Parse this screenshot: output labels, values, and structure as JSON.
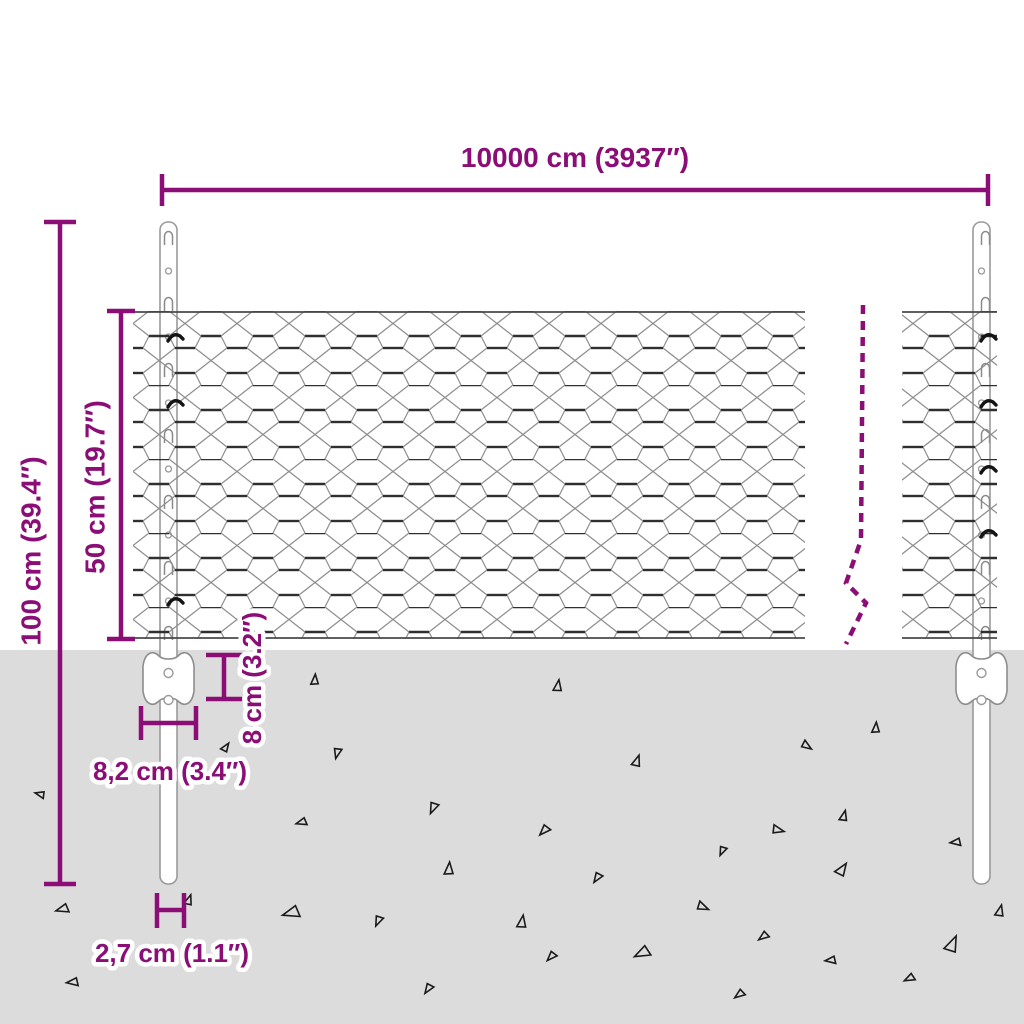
{
  "type": "product-dimension-diagram",
  "subject": "wire mesh fence with metal posts, partially buried in ground",
  "colors": {
    "accent": "#8a0e76",
    "ground": "#dcdcdc",
    "mesh_wire_thin": "#8c8c8c",
    "mesh_wire_twist": "#2f2f2f",
    "post_outline": "#9a9a9a",
    "background": "#ffffff"
  },
  "dimensions": {
    "total_width": {
      "label": "10000 cm (3937″)",
      "orientation": "horizontal"
    },
    "post_height": {
      "label": "100 cm (39.4″)",
      "orientation": "vertical"
    },
    "mesh_height": {
      "label": "50 cm (19.7″)",
      "orientation": "vertical"
    },
    "bracket_depth": {
      "label": "8 cm (3.2″)",
      "orientation": "vertical"
    },
    "bracket_width": {
      "label": "8,2 cm (3.4″)",
      "orientation": "horizontal"
    },
    "post_width": {
      "label": "2,7 cm (1.1″)",
      "orientation": "horizontal"
    }
  },
  "ground": {
    "triangles": [
      {
        "x": 314,
        "y": 680,
        "s": 10,
        "r": 0
      },
      {
        "x": 557,
        "y": 686,
        "s": 11,
        "r": 5
      },
      {
        "x": 338,
        "y": 753,
        "s": 10,
        "r": 190
      },
      {
        "x": 636,
        "y": 761,
        "s": 11,
        "r": 15
      },
      {
        "x": 807,
        "y": 745,
        "s": 10,
        "r": 120
      },
      {
        "x": 875,
        "y": 728,
        "s": 10,
        "r": 0
      },
      {
        "x": 434,
        "y": 808,
        "s": 11,
        "r": 200
      },
      {
        "x": 302,
        "y": 823,
        "s": 10,
        "r": 250
      },
      {
        "x": 545,
        "y": 831,
        "s": 11,
        "r": 220
      },
      {
        "x": 778,
        "y": 829,
        "s": 11,
        "r": 100
      },
      {
        "x": 843,
        "y": 816,
        "s": 10,
        "r": 10
      },
      {
        "x": 723,
        "y": 851,
        "s": 9,
        "r": 200
      },
      {
        "x": 956,
        "y": 843,
        "s": 10,
        "r": 260
      },
      {
        "x": 448,
        "y": 869,
        "s": 12,
        "r": 0
      },
      {
        "x": 598,
        "y": 878,
        "s": 10,
        "r": 210
      },
      {
        "x": 841,
        "y": 869,
        "s": 13,
        "r": 30
      },
      {
        "x": 703,
        "y": 906,
        "s": 11,
        "r": 110
      },
      {
        "x": 379,
        "y": 921,
        "s": 10,
        "r": 200
      },
      {
        "x": 521,
        "y": 922,
        "s": 12,
        "r": 5
      },
      {
        "x": 764,
        "y": 937,
        "s": 10,
        "r": 230
      },
      {
        "x": 999,
        "y": 911,
        "s": 11,
        "r": 10
      },
      {
        "x": 292,
        "y": 914,
        "s": 16,
        "r": 250
      },
      {
        "x": 951,
        "y": 944,
        "s": 16,
        "r": 20
      },
      {
        "x": 552,
        "y": 957,
        "s": 10,
        "r": 220
      },
      {
        "x": 643,
        "y": 954,
        "s": 15,
        "r": 240
      },
      {
        "x": 831,
        "y": 961,
        "s": 10,
        "r": 260
      },
      {
        "x": 910,
        "y": 979,
        "s": 10,
        "r": 240
      },
      {
        "x": 429,
        "y": 989,
        "s": 10,
        "r": 210
      },
      {
        "x": 740,
        "y": 995,
        "s": 10,
        "r": 230
      },
      {
        "x": 225,
        "y": 747,
        "s": 9,
        "r": 30
      },
      {
        "x": 63,
        "y": 910,
        "s": 12,
        "r": 250
      },
      {
        "x": 188,
        "y": 900,
        "s": 10,
        "r": 15
      },
      {
        "x": 73,
        "y": 983,
        "s": 11,
        "r": 260
      },
      {
        "x": 40,
        "y": 795,
        "s": 9,
        "r": 280
      }
    ]
  },
  "posts": {
    "slot_ys": [
      238,
      304,
      370,
      436,
      502,
      568,
      633
    ],
    "circle_ys": [
      271,
      337,
      403,
      469,
      535,
      601
    ],
    "left_hook_ys": [
      337,
      403,
      601
    ],
    "right_hook_ys": [
      337,
      403,
      469,
      533
    ]
  }
}
